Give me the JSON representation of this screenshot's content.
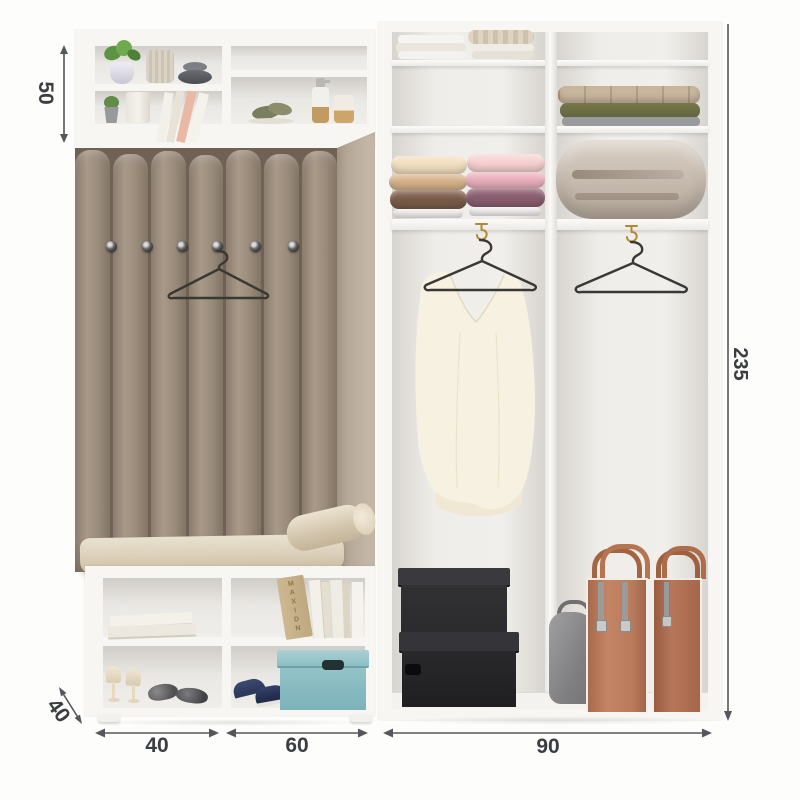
{
  "diagram": {
    "name": "hallway-and-wardrobe-dimension-diagram"
  },
  "dimensions": {
    "upper_shelf_height": "50",
    "total_height": "235",
    "depth": "40",
    "bench_unit_width": "40",
    "shoe_cabinet_width": "60",
    "wardrobe_width": "90"
  },
  "decor": {
    "book_spine_text": "MAXIDN"
  },
  "colors": {
    "dim-line": "#55575a",
    "dim-text": "#3b3d40",
    "frame-white": "#f7f6f3",
    "interior-gray": "#e9e6e2",
    "panel-taupe": "#998a7a",
    "panel-seam": "#6f6254",
    "cushion-cream": "#dccfb9",
    "teal-box": "#8cbfc5",
    "navy-shoe": "#2e3a5c",
    "black-box": "#2b2b2e",
    "tote-tan": "#b97a5c",
    "blouse-ivory": "#f7f1e2",
    "gold-hook": "#b08a33",
    "hanger-wire": "#3a3834"
  }
}
